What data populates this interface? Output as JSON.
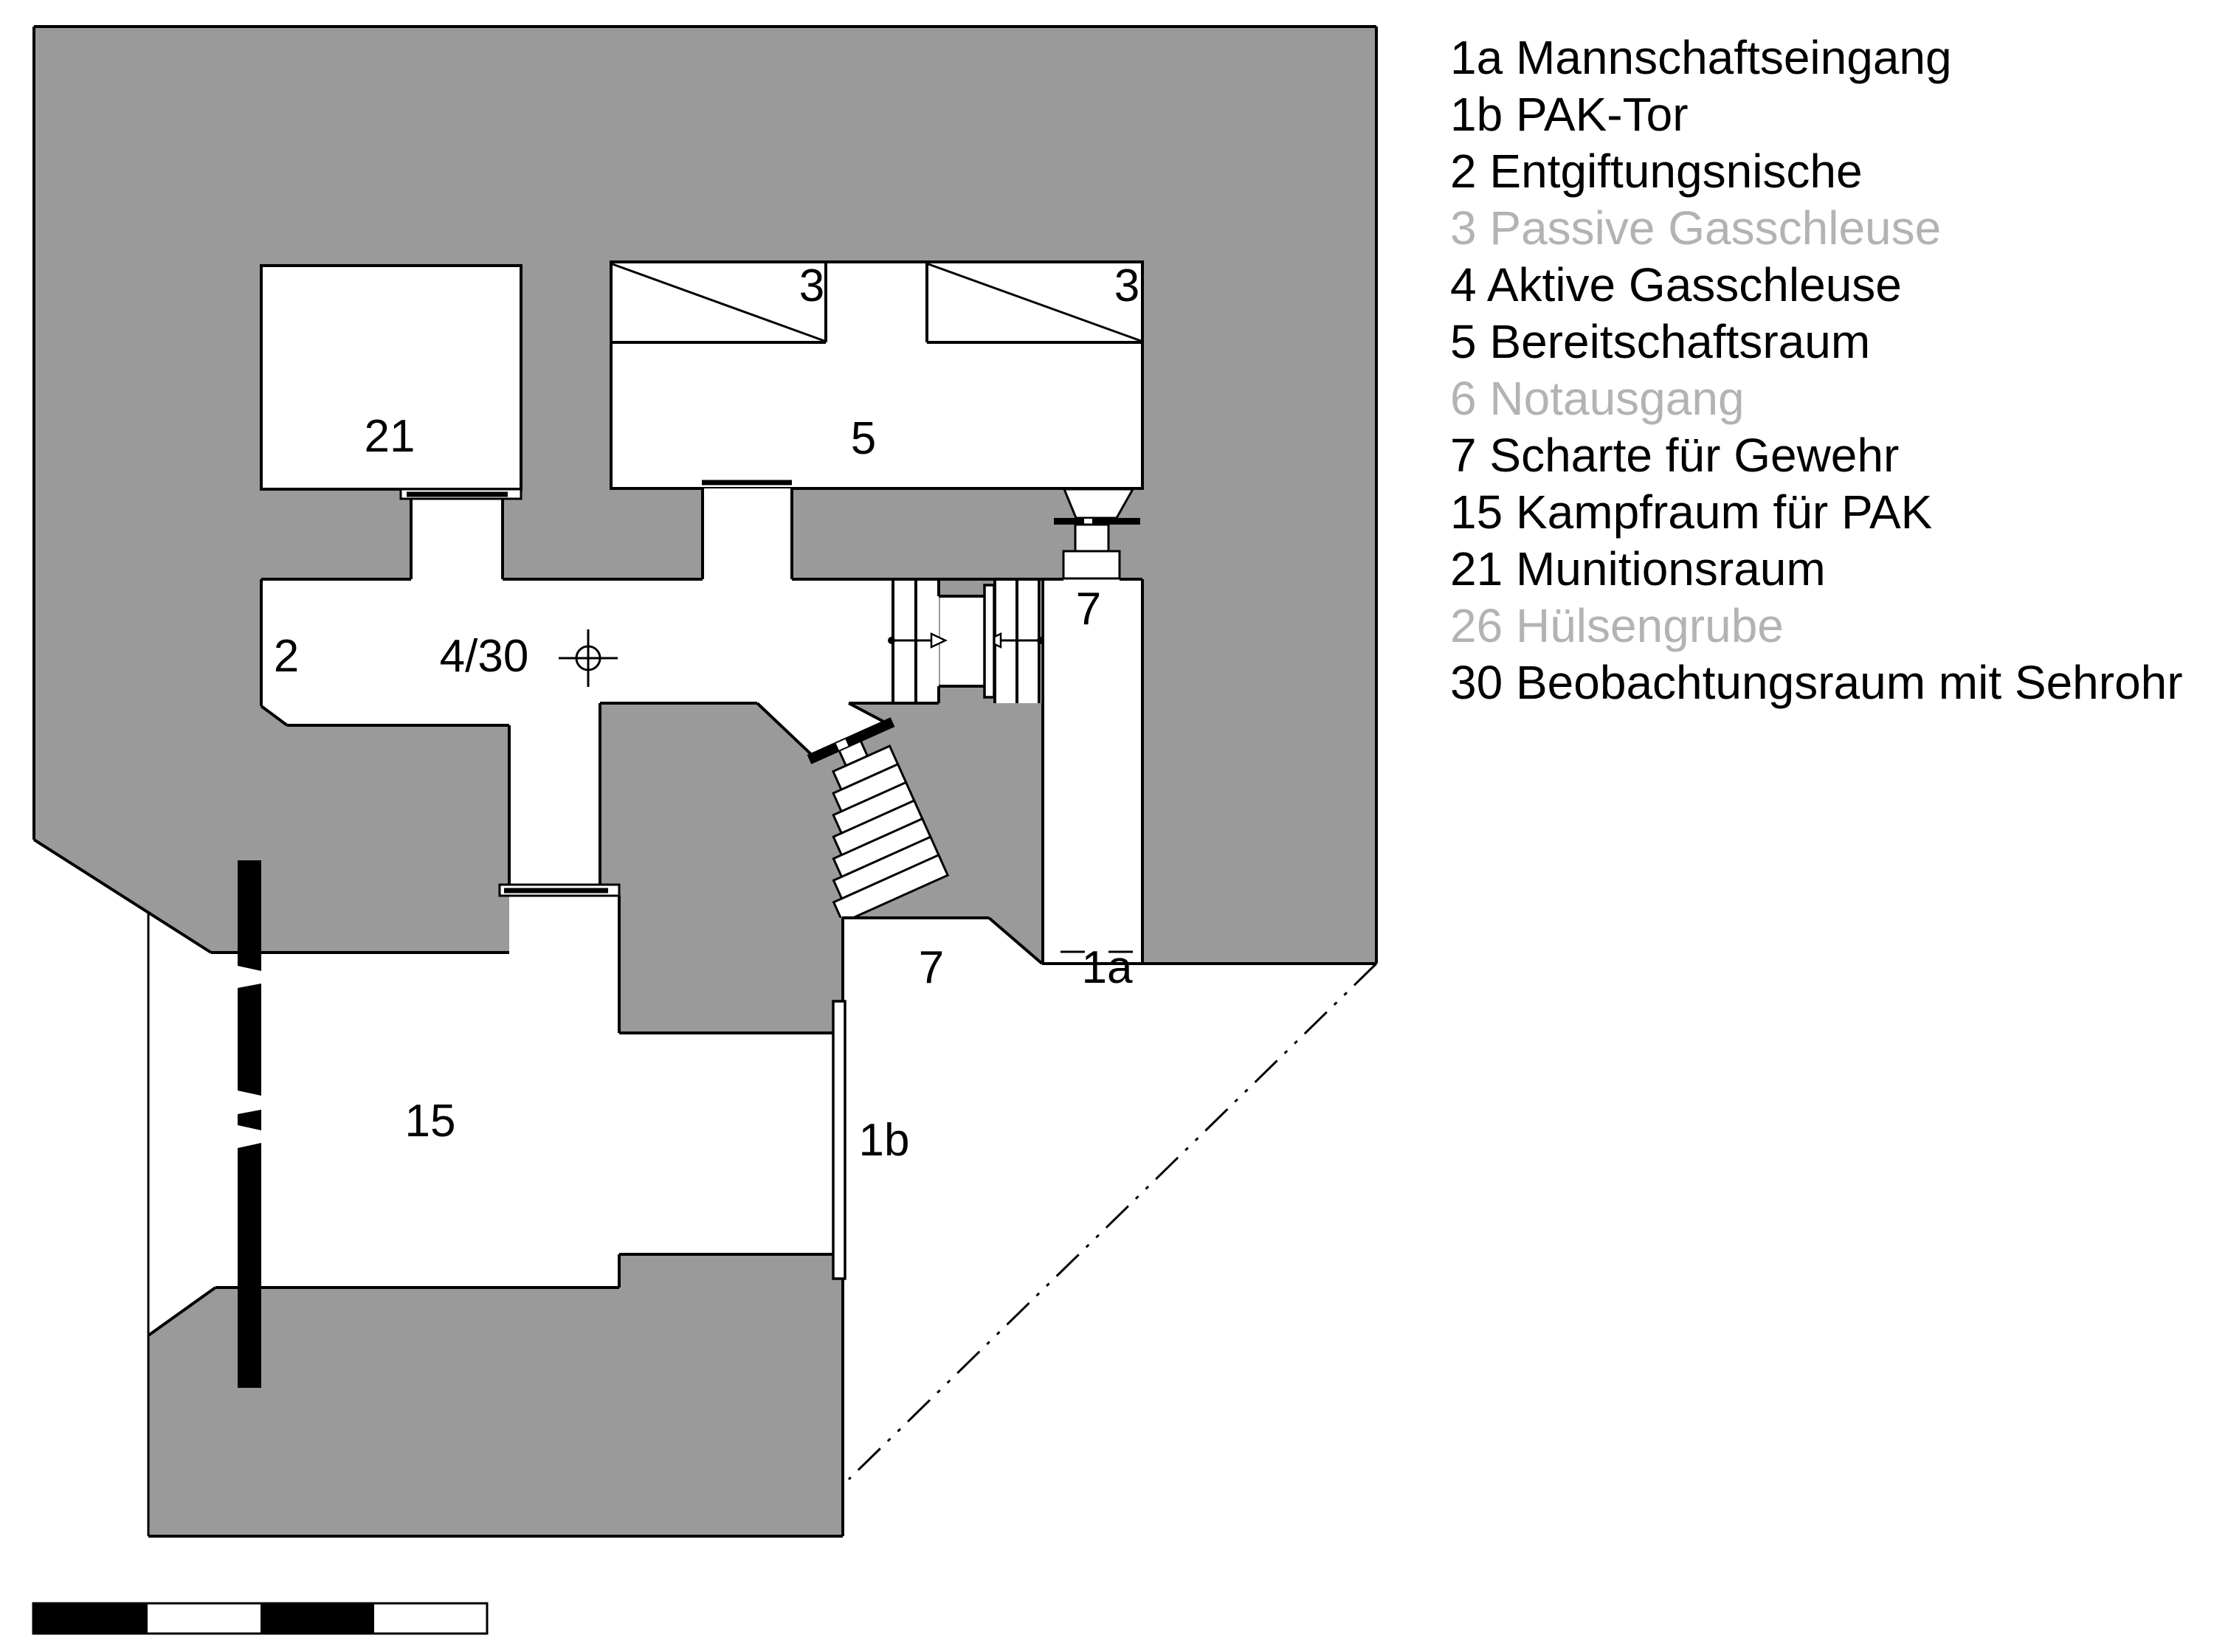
{
  "plan": {
    "labels": {
      "room21": "21",
      "room5": "5",
      "room3a": "3",
      "room3b": "3",
      "room2": "2",
      "room4_30": "4/30",
      "scharte_top": "7",
      "scharte_stairs": "7",
      "entrance_1a": "1a",
      "door_1b": "1b",
      "room15": "15"
    }
  },
  "legend": {
    "items": [
      {
        "number": "1a",
        "label": "Mannschaftseingang",
        "dimmed": false
      },
      {
        "number": "1b",
        "label": "PAK-Tor",
        "dimmed": false
      },
      {
        "number": "2",
        "label": "Entgiftungsnische",
        "dimmed": false
      },
      {
        "number": "3",
        "label": "Passive Gasschleuse",
        "dimmed": true
      },
      {
        "number": "4",
        "label": "Aktive Gasschleuse",
        "dimmed": false
      },
      {
        "number": "5",
        "label": "Bereitschaftsraum",
        "dimmed": false
      },
      {
        "number": "6",
        "label": "Notausgang",
        "dimmed": true
      },
      {
        "number": "7",
        "label": "Scharte für Gewehr",
        "dimmed": false
      },
      {
        "number": "15",
        "label": "Kampfraum für PAK",
        "dimmed": false
      },
      {
        "number": "21",
        "label": "Munitionsraum",
        "dimmed": false
      },
      {
        "number": "26",
        "label": "Hülsengrube",
        "dimmed": true
      },
      {
        "number": "30",
        "label": "Beobachtungsraum mit Sehrohr",
        "dimmed": false
      }
    ]
  },
  "colors": {
    "concrete": "#9A9A9A",
    "dimmedText": "#B3B3B3",
    "line": "#000000"
  }
}
